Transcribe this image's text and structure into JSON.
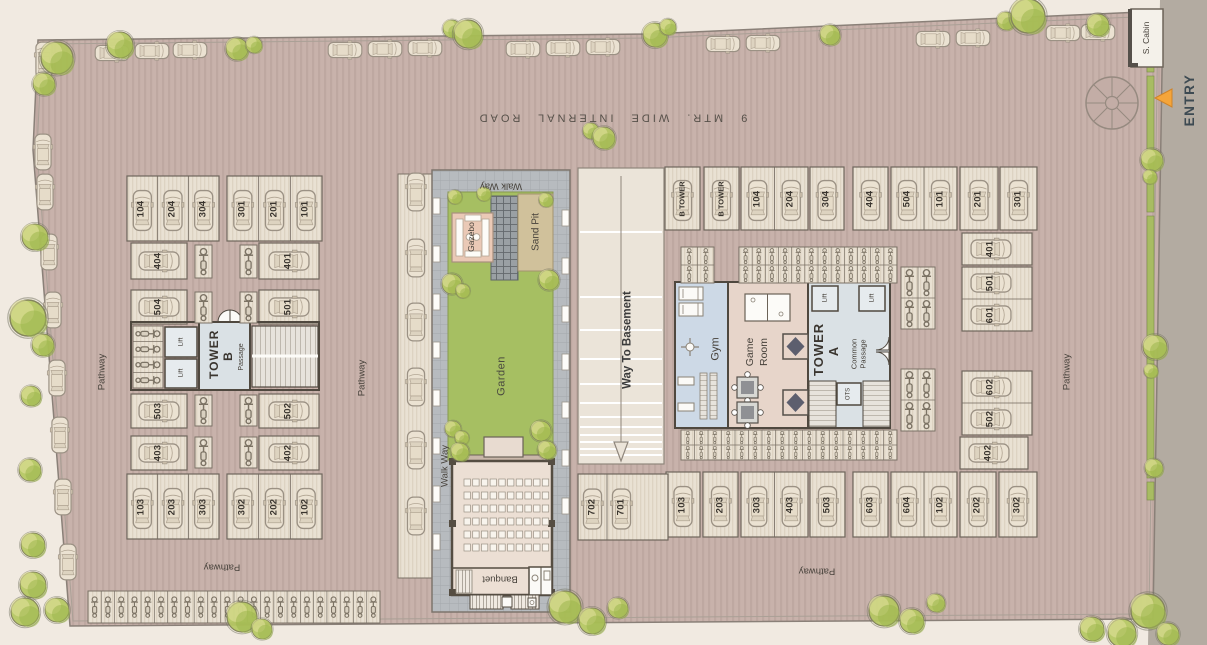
{
  "site": {
    "road_label": "9 MTR. WIDE INTERNAL ROAD",
    "entry_label": "ENTRY",
    "security_cabin_label": "S. Cabin"
  },
  "labels": {
    "pathway": "Pathway",
    "walk_way": "Walk Way",
    "garden": "Garden",
    "gazebo": "Gazebo",
    "sand_pit": "Sand Pit",
    "way_to_basement": "Way To Basement",
    "banquet": "Banquet",
    "gym": "Gym",
    "game_room": "Game Room",
    "tower_a": "TOWER A",
    "tower_b": "TOWER B",
    "common_passage": "Common Passage",
    "passage": "Passage",
    "lift": "Lift",
    "ots": "OTS"
  },
  "parking": {
    "stall_groups": [
      {
        "x": 127,
        "y": 176,
        "w": 92,
        "h": 65,
        "dir": "v",
        "labels": [
          "104",
          "204",
          "304"
        ]
      },
      {
        "x": 227,
        "y": 176,
        "w": 95,
        "h": 65,
        "dir": "v",
        "labels": [
          "301",
          "201",
          "101"
        ]
      },
      {
        "x": 131,
        "y": 243,
        "w": 56,
        "h": 36,
        "dir": "h",
        "labels": [
          "404"
        ]
      },
      {
        "x": 259,
        "y": 243,
        "w": 60,
        "h": 36,
        "dir": "h",
        "labels": [
          "401"
        ]
      },
      {
        "x": 131,
        "y": 290,
        "w": 56,
        "h": 34,
        "dir": "h",
        "labels": [
          "504"
        ]
      },
      {
        "x": 259,
        "y": 290,
        "w": 60,
        "h": 34,
        "dir": "h",
        "labels": [
          "501"
        ]
      },
      {
        "x": 131,
        "y": 394,
        "w": 56,
        "h": 34,
        "dir": "h",
        "labels": [
          "503"
        ]
      },
      {
        "x": 259,
        "y": 394,
        "w": 60,
        "h": 34,
        "dir": "h",
        "labels": [
          "502"
        ]
      },
      {
        "x": 131,
        "y": 436,
        "w": 56,
        "h": 34,
        "dir": "h",
        "labels": [
          "403"
        ]
      },
      {
        "x": 259,
        "y": 436,
        "w": 60,
        "h": 34,
        "dir": "h",
        "labels": [
          "402"
        ]
      },
      {
        "x": 127,
        "y": 474,
        "w": 92,
        "h": 65,
        "dir": "v",
        "labels": [
          "103",
          "203",
          "303"
        ]
      },
      {
        "x": 227,
        "y": 474,
        "w": 95,
        "h": 65,
        "dir": "v",
        "labels": [
          "302",
          "202",
          "102"
        ]
      },
      {
        "x": 665,
        "y": 167,
        "w": 35,
        "h": 63,
        "dir": "v",
        "small": true,
        "labels": [
          "B TOWER"
        ]
      },
      {
        "x": 704,
        "y": 167,
        "w": 35,
        "h": 63,
        "dir": "v",
        "small": true,
        "labels": [
          "B TOWER"
        ]
      },
      {
        "x": 741,
        "y": 167,
        "w": 67,
        "h": 63,
        "dir": "v",
        "labels": [
          "104",
          "204"
        ]
      },
      {
        "x": 810,
        "y": 167,
        "w": 34,
        "h": 63,
        "dir": "v",
        "labels": [
          "304"
        ]
      },
      {
        "x": 853,
        "y": 167,
        "w": 35,
        "h": 63,
        "dir": "v",
        "labels": [
          "404"
        ]
      },
      {
        "x": 891,
        "y": 167,
        "w": 66,
        "h": 63,
        "dir": "v",
        "labels": [
          "504",
          "101"
        ]
      },
      {
        "x": 960,
        "y": 167,
        "w": 38,
        "h": 63,
        "dir": "v",
        "labels": [
          "201"
        ]
      },
      {
        "x": 1000,
        "y": 167,
        "w": 37,
        "h": 63,
        "dir": "v",
        "labels": [
          "301"
        ]
      },
      {
        "x": 962,
        "y": 233,
        "w": 70,
        "h": 32,
        "dir": "h",
        "span": 58,
        "labels": [
          "401"
        ]
      },
      {
        "x": 962,
        "y": 267,
        "w": 70,
        "h": 64,
        "dir": "h",
        "span": 58,
        "labels": [
          "501",
          "601"
        ]
      },
      {
        "x": 962,
        "y": 371,
        "w": 70,
        "h": 64,
        "dir": "h",
        "span": 58,
        "labels": [
          "602",
          "502"
        ]
      },
      {
        "x": 960,
        "y": 437,
        "w": 68,
        "h": 32,
        "dir": "h",
        "span": 58,
        "labels": [
          "402"
        ]
      },
      {
        "x": 666,
        "y": 472,
        "w": 34,
        "h": 65,
        "dir": "v",
        "labels": [
          "103"
        ]
      },
      {
        "x": 703,
        "y": 472,
        "w": 35,
        "h": 65,
        "dir": "v",
        "labels": [
          "203"
        ]
      },
      {
        "x": 741,
        "y": 472,
        "w": 67,
        "h": 65,
        "dir": "v",
        "labels": [
          "303",
          "403"
        ]
      },
      {
        "x": 810,
        "y": 472,
        "w": 35,
        "h": 65,
        "dir": "v",
        "labels": [
          "503"
        ]
      },
      {
        "x": 853,
        "y": 472,
        "w": 35,
        "h": 65,
        "dir": "v",
        "labels": [
          "603"
        ]
      },
      {
        "x": 891,
        "y": 472,
        "w": 66,
        "h": 65,
        "dir": "v",
        "labels": [
          "604",
          "102"
        ]
      },
      {
        "x": 960,
        "y": 472,
        "w": 36,
        "h": 65,
        "dir": "v",
        "labels": [
          "202"
        ]
      },
      {
        "x": 999,
        "y": 472,
        "w": 38,
        "h": 65,
        "dir": "v",
        "labels": [
          "302"
        ]
      },
      {
        "x": 578,
        "y": 474,
        "w": 90,
        "h": 66,
        "dir": "v",
        "span": 58,
        "labels": [
          "702",
          "701"
        ]
      }
    ]
  },
  "colors": {
    "plot_fill": "#c8b2ab",
    "stall_fill": "#e9e1d3",
    "garden_green": "#a6bf62",
    "gym_blue": "#cdd9e6",
    "game_room_pink": "#e7d5ca",
    "gazebo_pink": "#eac9b6",
    "sand_tan": "#d0c19b",
    "entry_arrow_orange": "#f5a53a",
    "outer_road_gray": "#b3aba1",
    "tree_green": "#b4c75f"
  }
}
